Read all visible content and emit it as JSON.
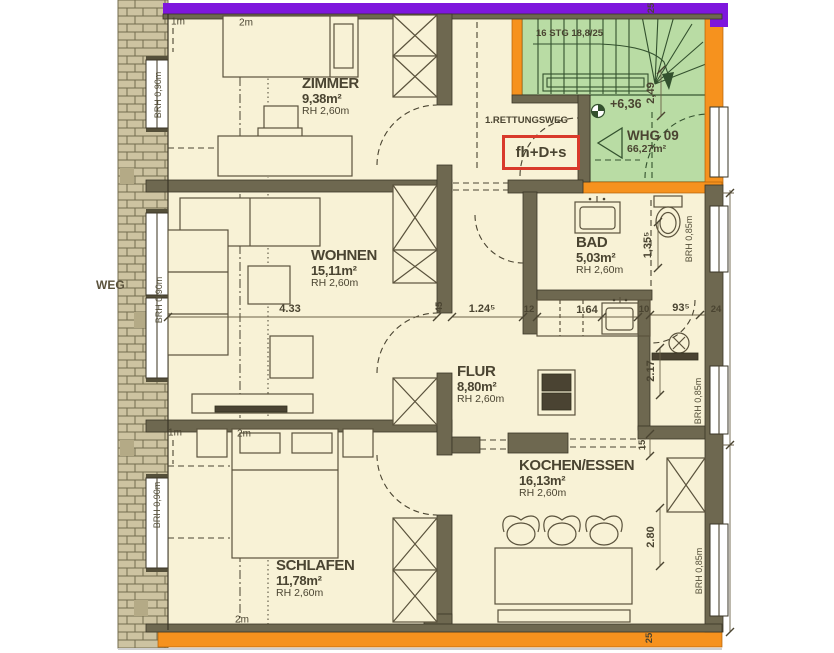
{
  "plan_labels": {
    "rooms": {
      "zimmer": {
        "name": "ZIMMER",
        "area": "9,38m²",
        "height": "RH 2,60m"
      },
      "wohnen": {
        "name": "WOHNEN",
        "area": "15,11m²",
        "height": "RH 2,60m"
      },
      "schlafen": {
        "name": "SCHLAFEN",
        "area": "11,78m²",
        "height": "RH 2,60m"
      },
      "flur": {
        "name": "FLUR",
        "area": "8,80m²",
        "height": "RH 2,60m"
      },
      "bad": {
        "name": "BAD",
        "area": "5,03m²",
        "height": "RH 2,60m"
      },
      "kochen": {
        "name": "KOCHEN/ESSEN",
        "area": "16,13m²",
        "height": "RH 2,60m"
      }
    },
    "apartment": {
      "name": "WHG 09",
      "area": "66,27m²",
      "level": "+6,36"
    },
    "staircase": {
      "label": "16 STG 18,8/25"
    },
    "escape_route": {
      "label": "1.RETTUNGSWEG",
      "door_code": "fh+D+s"
    },
    "window_sills": {
      "left": "BRH 0,90m",
      "right": "BRH 0,85m"
    },
    "roof_heights": {
      "h1": "1m",
      "h2": "2m"
    },
    "outside": "WEG"
  },
  "dimensions": {
    "wohnen_width": "4.33",
    "flur_width": "1.24⁵",
    "kitchen_counter": "1.64",
    "shower_width": "93⁵",
    "stair_run": "2,49",
    "bad_fixture": "1,35⁵",
    "shower_depth": "2.17",
    "dining_depth": "2.80",
    "t24": "24",
    "t25": "25",
    "t12": "12",
    "t10": "10",
    "t15": "15",
    "t45": "45"
  },
  "colors": {
    "room_fill": "#f8f2d6",
    "wall": "#6e6850",
    "stair_fill": "#b9dca4",
    "fire_wall_orange": "#f6921e",
    "top_band_purple": "#7e16dd",
    "escape_box_red": "#d93a2b",
    "line": "#4a4431"
  }
}
